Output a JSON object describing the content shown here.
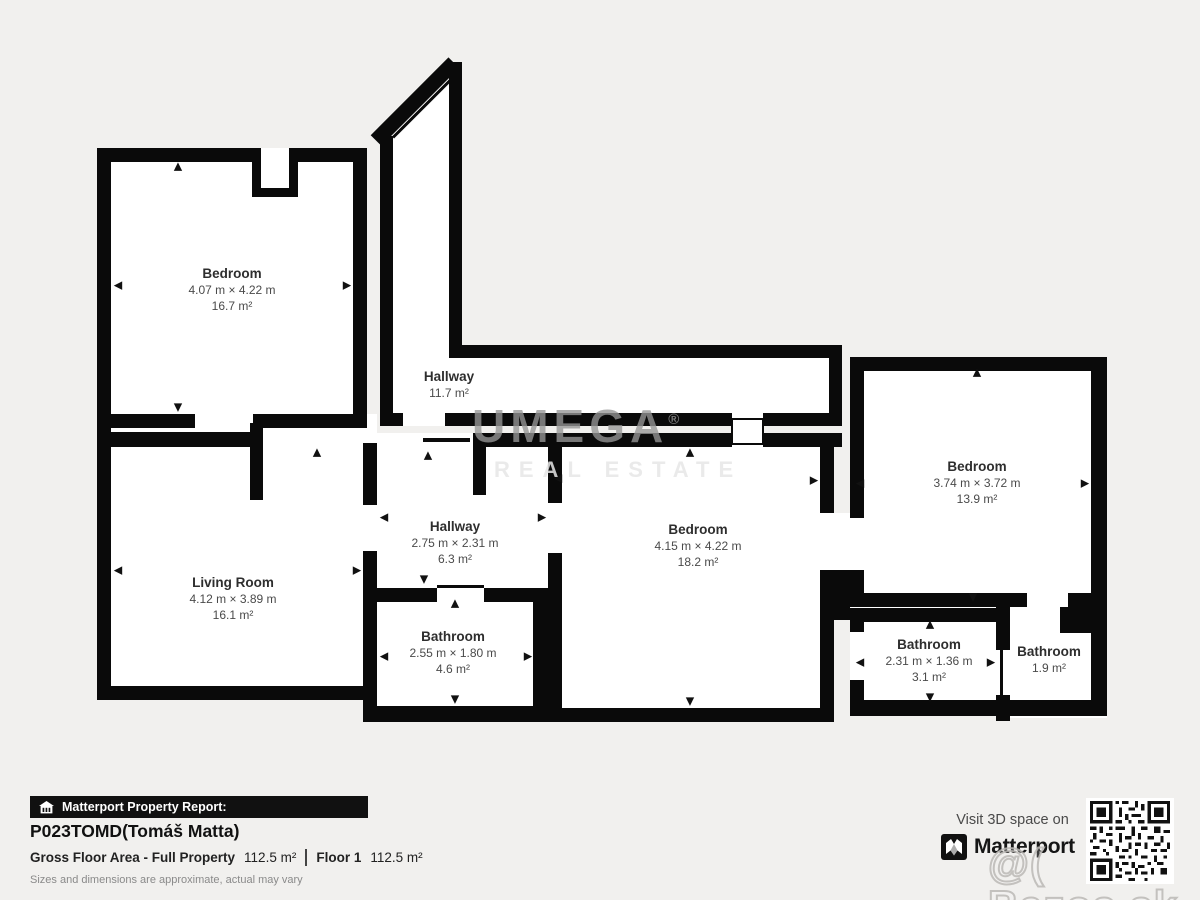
{
  "plan": {
    "rooms": [
      {
        "name": "Bedroom",
        "dims": "4.07 m × 4.22 m",
        "area": "16.7 m²"
      },
      {
        "name": "Hallway",
        "dims": "",
        "area": "11.7 m²"
      },
      {
        "name": "Living Room",
        "dims": "4.12 m × 3.89 m",
        "area": "16.1 m²"
      },
      {
        "name": "Hallway",
        "dims": "2.75 m × 2.31 m",
        "area": "6.3 m²"
      },
      {
        "name": "Bathroom",
        "dims": "2.55 m × 1.80 m",
        "area": "4.6 m²"
      },
      {
        "name": "Bedroom",
        "dims": "4.15 m × 4.22 m",
        "area": "18.2 m²"
      },
      {
        "name": "Bedroom",
        "dims": "3.74 m × 3.72 m",
        "area": "13.9 m²"
      },
      {
        "name": "Bathroom",
        "dims": "2.31 m × 1.36 m",
        "area": "3.1 m²"
      },
      {
        "name": "Bathroom",
        "dims": "",
        "area": "1.9 m²"
      }
    ],
    "icons": {
      "up": "▲",
      "down": "▼",
      "left": "◀",
      "right": "▶"
    },
    "wall_color": "#0a0a0a",
    "room_color": "#ffffff",
    "background_color": "#f1f0ee"
  },
  "watermark": {
    "brand": "UMEGA",
    "reg": "®",
    "sub": "REAL ESTATE",
    "photo": "@( Bazos.sk"
  },
  "footer": {
    "report_label": "Matterport Property Report:",
    "title": "P023TOMD(Tomáš Matta)",
    "gfa_label": "Gross Floor Area - Full Property",
    "gfa_value": "112.5 m²",
    "floor_label": "Floor 1",
    "floor_value": "112.5 m²",
    "disclaimer": "Sizes and dimensions are approximate, actual may vary",
    "visit_text": "Visit 3D space on",
    "brand": "Matterport"
  }
}
